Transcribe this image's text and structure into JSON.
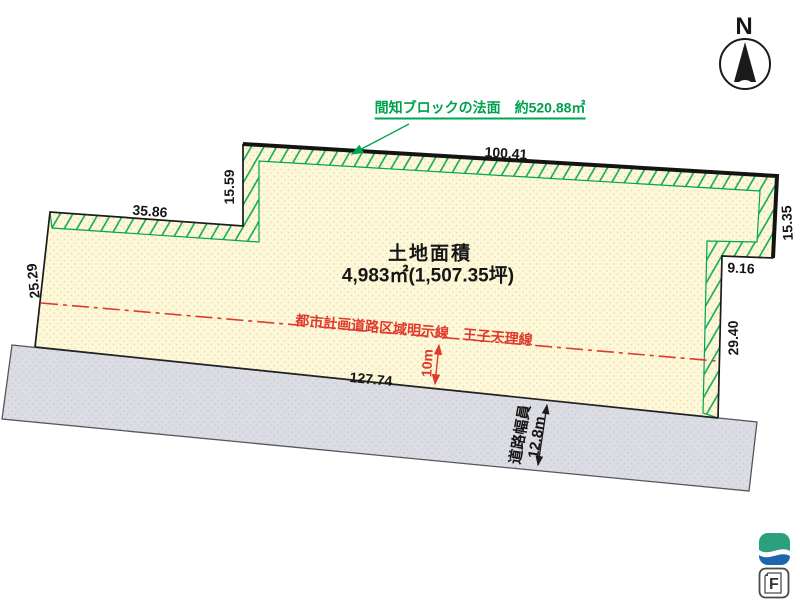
{
  "compass": {
    "north_label": "N"
  },
  "slope_annotation": {
    "text": "間知ブロックの法面　約520.88㎡"
  },
  "site": {
    "area_title": "土地面積",
    "area_value": "4,983㎡(1,507.35坪)",
    "dimensions": {
      "top_edge": "100.41",
      "top_left_edge": "35.86",
      "step_left": "15.59",
      "left_edge": "25.29",
      "right_upper_edge": "15.35",
      "step_right": "9.16",
      "right_lower_edge": "29.40",
      "bottom_edge": "127.74"
    }
  },
  "planning_road": {
    "line_label": "都市計画道路区域明示線　王子天理線",
    "offset_label": "10m"
  },
  "road": {
    "width_title": "道路幅員",
    "width_value": "12.8m"
  },
  "logo": {
    "f_label": "F"
  },
  "colors": {
    "plot_fill": "#fcf8d9",
    "plot_dots": "#edd79c",
    "hatch_green": "#00a551",
    "note_green": "#00a04e",
    "road_fill": "#dbdce4",
    "road_dots": "#c7c8d2",
    "annotation_red": "#e0392d",
    "boundary_black": "#1c1c1c",
    "logo_green": "#2aa17c",
    "logo_blue": "#1e66ad"
  }
}
